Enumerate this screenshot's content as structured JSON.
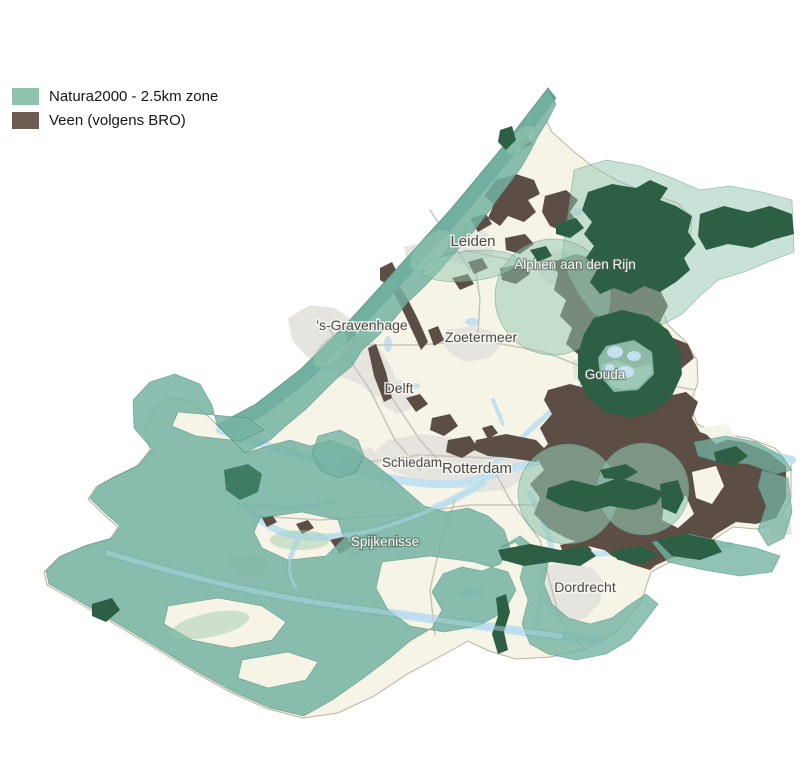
{
  "legend": {
    "items": [
      {
        "label": "Natura2000 - 2.5km zone",
        "color": "#8ec4ae"
      },
      {
        "label": "Veen (volgens BRO)",
        "color": "#6e5b52"
      }
    ]
  },
  "map": {
    "cities": [
      {
        "name": "Leiden",
        "style": "dark"
      },
      {
        "name": "Alphen aan den Rijn",
        "style": "light"
      },
      {
        "name": "'s-Gravenhage",
        "style": "dark"
      },
      {
        "name": "Zoetermeer",
        "style": "dark"
      },
      {
        "name": "Delft",
        "style": "dark"
      },
      {
        "name": "Gouda",
        "style": "light"
      },
      {
        "name": "Schiedam",
        "style": "dark"
      },
      {
        "name": "Rotterdam",
        "style": "dark"
      },
      {
        "name": "Spijkenisse",
        "style": "light"
      },
      {
        "name": "Dordrecht",
        "style": "dark"
      }
    ]
  },
  "colors": {
    "land": "#f6f4e6",
    "border_line": "#b9b2a2",
    "urban": "#e5e4df",
    "water": "#c4e1f0",
    "road": "#c9c4ba",
    "veen": "#5d4e45",
    "teal_zone": "#74b3a2",
    "teal_core": "#549e8e",
    "teal_light": "#93c5b0",
    "zone_edge": "#49897a",
    "overlap_green": "#2d5f45",
    "overlap_soft": "#3e7c64",
    "mottle": "#9ac7ae",
    "river_over": "rgba(185,220,235,0.45)",
    "label_dark": "#4b4b4b",
    "label_light": "#fbfbf7"
  }
}
